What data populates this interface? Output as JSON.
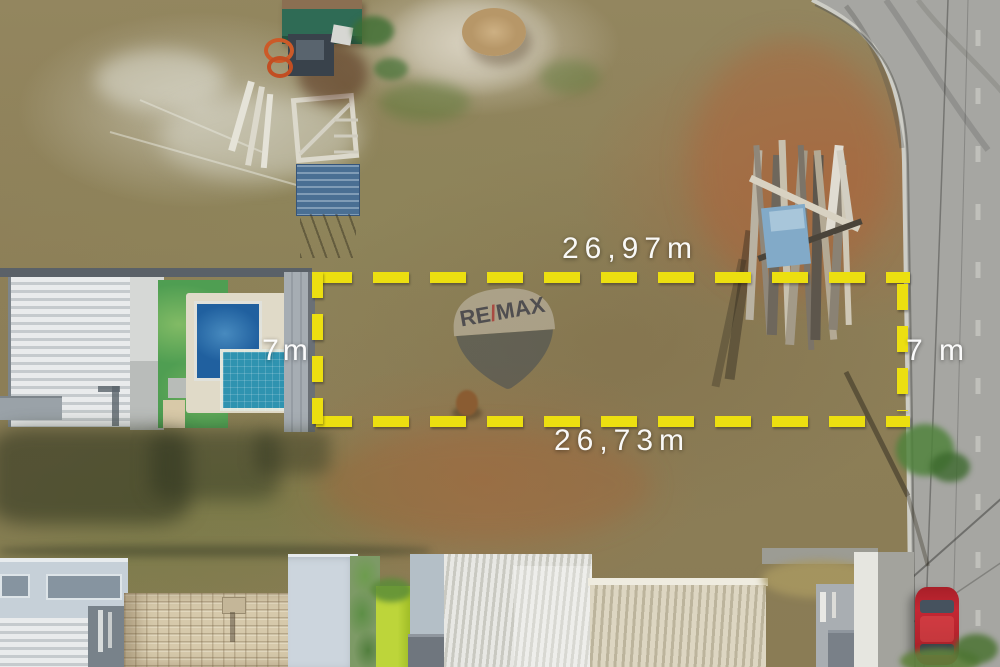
{
  "annotations": {
    "boundary_color": "#ecdf10",
    "label_color": "#ffffff",
    "top_length": "26,97m",
    "bottom_length": "26,73m",
    "left_width": "7m",
    "right_width": "7 m"
  },
  "watermark": {
    "brand_re": "RE",
    "brand_slash": "/",
    "brand_max": "MAX",
    "slash_color": "#a83c36"
  }
}
